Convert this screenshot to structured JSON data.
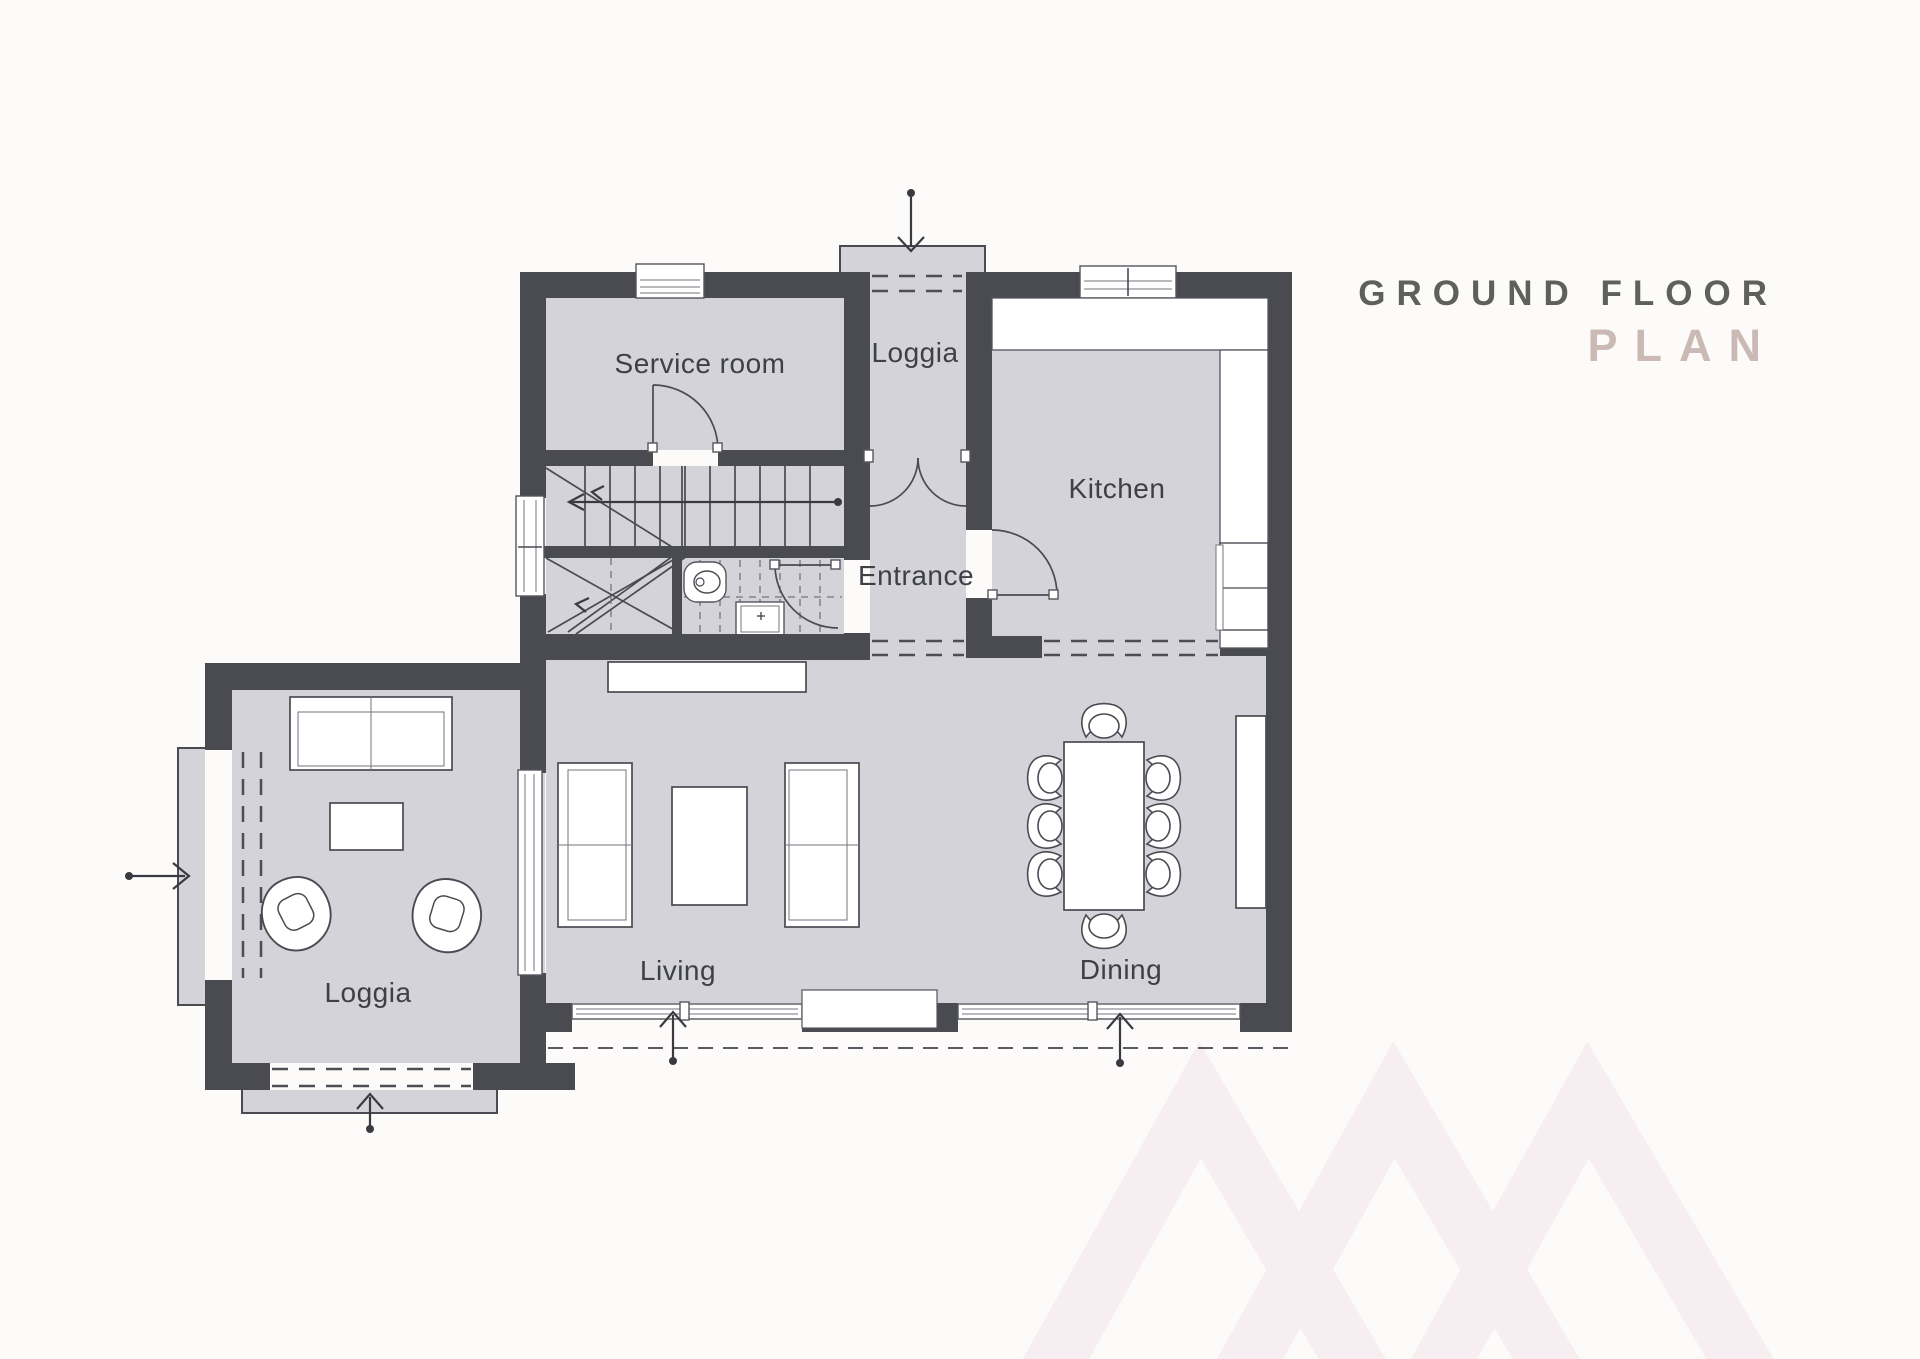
{
  "title": {
    "line1": "GROUND FLOOR",
    "line2": "PLAN"
  },
  "rooms": {
    "service_room": {
      "label": "Service room"
    },
    "loggia_top": {
      "label": "Loggia"
    },
    "kitchen": {
      "label": "Kitchen"
    },
    "entrance": {
      "label": "Entrance"
    },
    "living": {
      "label": "Living"
    },
    "dining": {
      "label": "Dining"
    },
    "loggia_side": {
      "label": "Loggia"
    }
  },
  "colors": {
    "background": "#fcfbfa",
    "wall": "#4a4a51",
    "floor": "#d3d3d9",
    "line": "#4a4a52",
    "label": "#3d4046",
    "title_primary": "#5d605d",
    "title_accent": "#cbb9b5",
    "watermark": "#f6eef0"
  },
  "icons": {
    "entry_arrow": "open-chevron-arrow-with-dot",
    "stairs": "winder-staircase-top-view",
    "toilet": "toilet-top-view",
    "sink": "washbasin-top-view",
    "door_swing": "quarter-circle-arc",
    "sofa": "sofa-top-view",
    "armchair": "swivel-armchair-top-view",
    "dining_set": "table-with-8-chairs-top-view",
    "watermark": "chevron-zigzag"
  }
}
